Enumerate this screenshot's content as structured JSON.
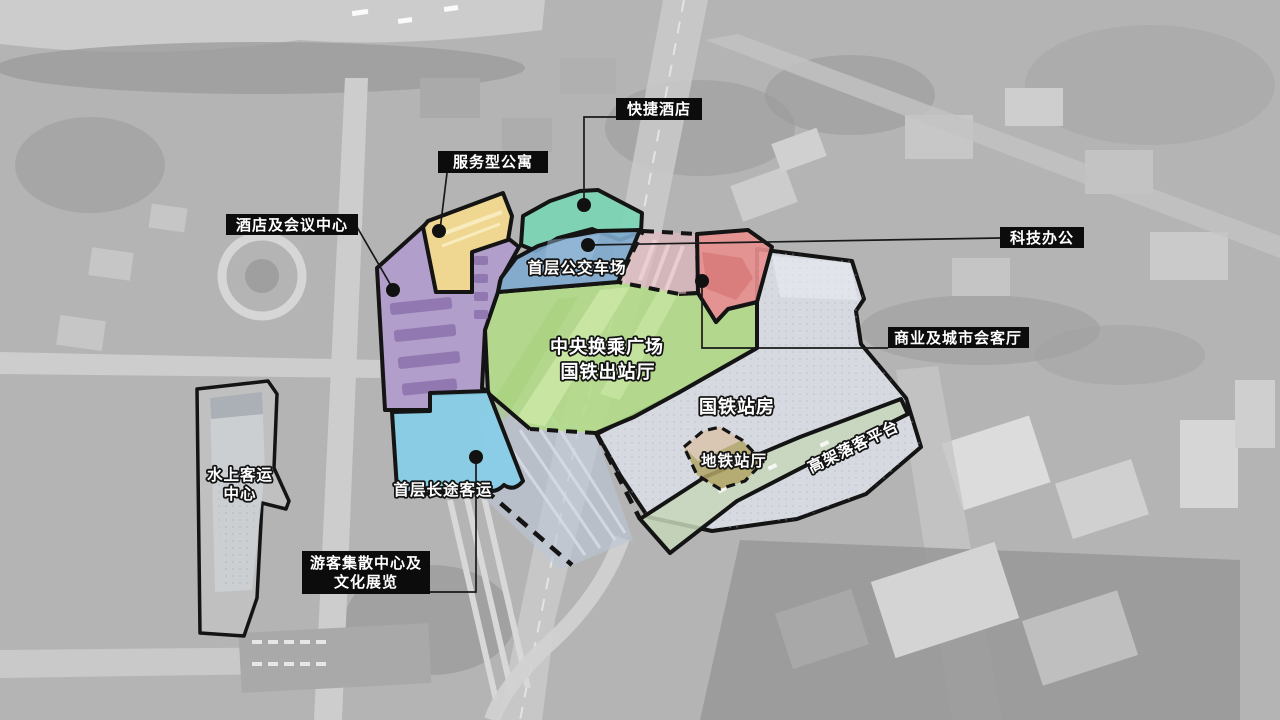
{
  "diagram_title": "站城综合开发功能分区示意图",
  "colors": {
    "outline": "#141414",
    "leader": "#1a1a1a",
    "dot": "#111111",
    "label_box_bg": "#0c0c0c",
    "label_text": "#ffffff",
    "hotel_conference": "#b19bcd",
    "hotel_conference_detail": "#8d71ad",
    "serviced_apartment": "#f3d98f",
    "serviced_apartment_stripe": "#f8ebbd",
    "express_hotel": "#7cd5b5",
    "bus_terminal": "#7ea8ce",
    "bus_terminal_stripe": "#9fc3e0",
    "central_plaza": "#b2dc88",
    "central_plaza_light": "#cfeaa8",
    "central_plaza_dark": "#a4cf78",
    "tech_office_zone": "#e7b7bd",
    "tech_office_stripe": "#f0d5d8",
    "commercial_zone": "#e98f8f",
    "commercial_zone_dark": "#d87b7b",
    "long_distance_bus": "#84cfe9",
    "rail_station_zone": "#d9dce4",
    "rail_station_highlight": "#f0f2f6",
    "drop_off_platform_zone": "#c7d6ba",
    "metro_hall_tan": "#dbc9ba",
    "metro_hall_khaki": "#b2a465",
    "viaduct_band": "#bdc6d6",
    "photo_base": "#b4b4b4"
  },
  "boxed_labels": {
    "express_hotel": "快捷酒店",
    "serviced_apartment": "服务型公寓",
    "hotel_conference": "酒店及会议中心",
    "tech_office": "科技办公",
    "commercial_lounge": "商业及城市会客厅",
    "tourist_center_line1": "游客集散中心及",
    "tourist_center_line2": "文化展览"
  },
  "zone_labels": {
    "bus_terminal": "首层公交车场",
    "central_plaza_line1": "中央换乘广场",
    "central_plaza_line2": "国铁出站厅",
    "rail_station": "国铁站房",
    "metro_hall": "地铁站厅",
    "drop_off_platform": "高架落客平台",
    "water_terminal_line1": "水上客运",
    "water_terminal_line2": "中心",
    "long_distance_bus": "首层长途客运"
  }
}
